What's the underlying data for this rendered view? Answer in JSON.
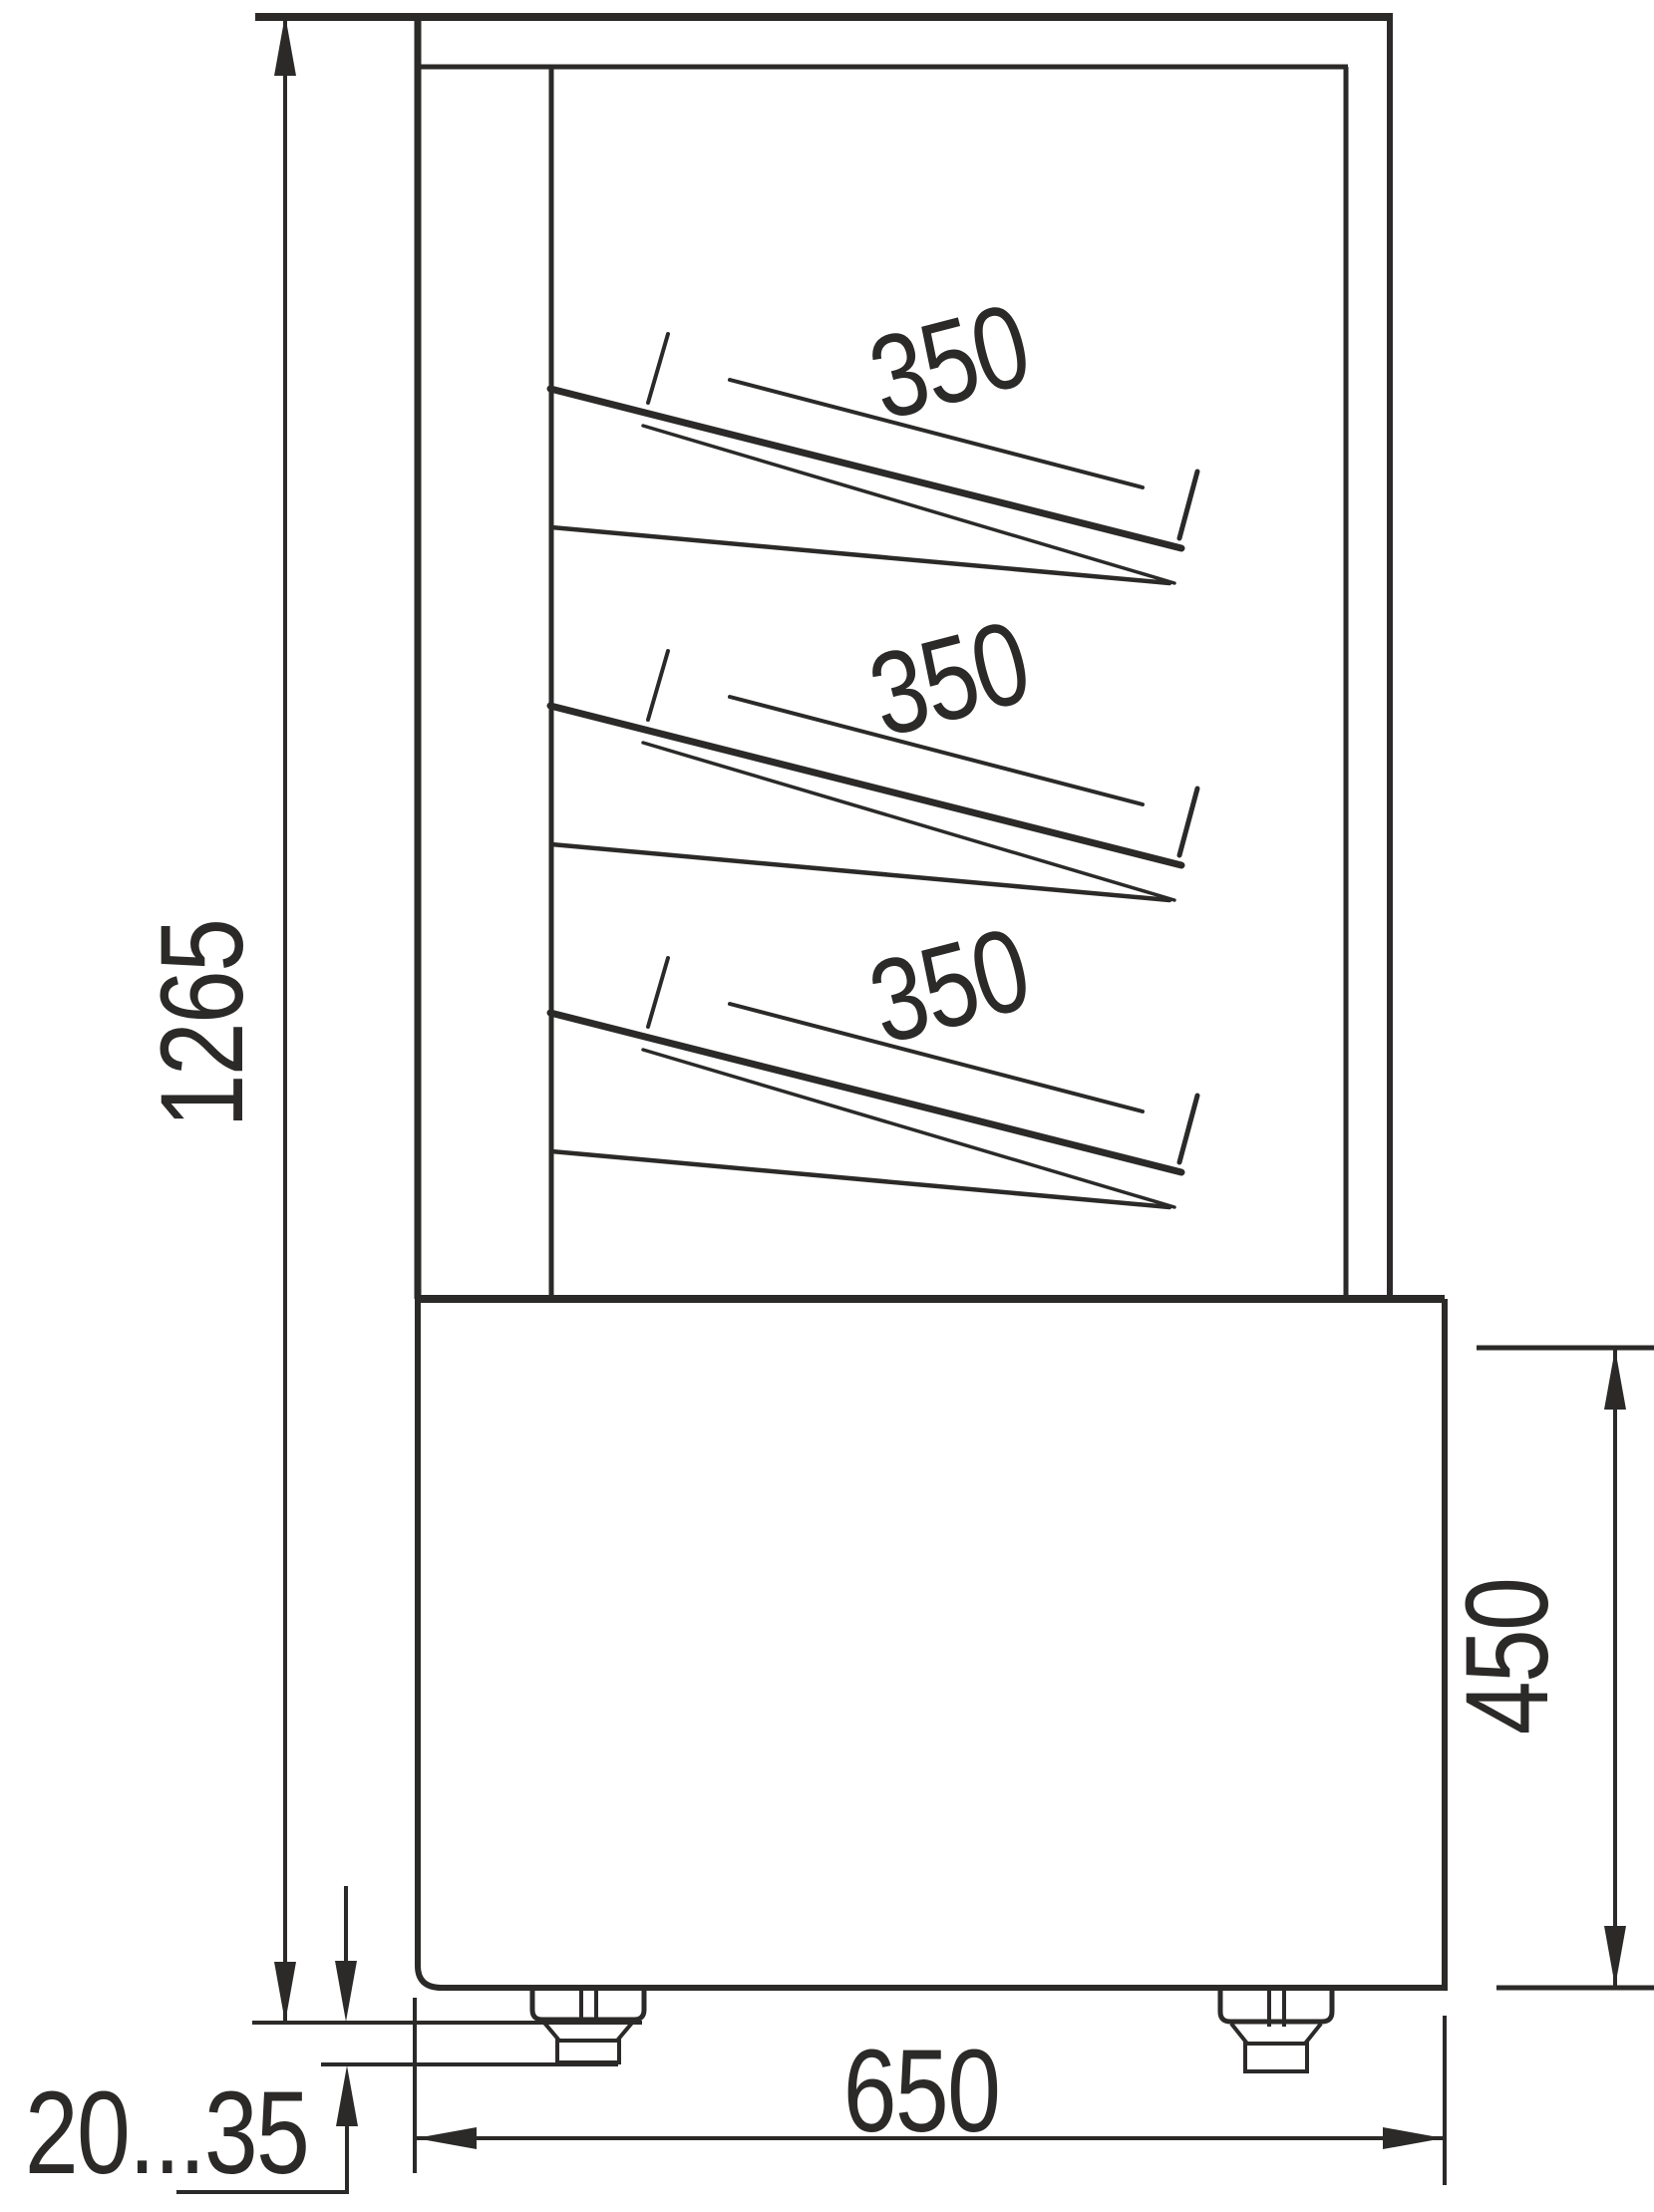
{
  "drawing": {
    "type": "technical-dimension-drawing",
    "view": "display-case-side-view",
    "colors": {
      "line": "#2b2a29",
      "background": "#ffffff"
    },
    "labels": {
      "overall_height": "1265",
      "base_depth": "650",
      "base_height": "450",
      "foot_adjust_range": "20...35"
    },
    "shelves": [
      {
        "depth_label": "350"
      },
      {
        "depth_label": "350"
      },
      {
        "depth_label": "350"
      }
    ]
  }
}
